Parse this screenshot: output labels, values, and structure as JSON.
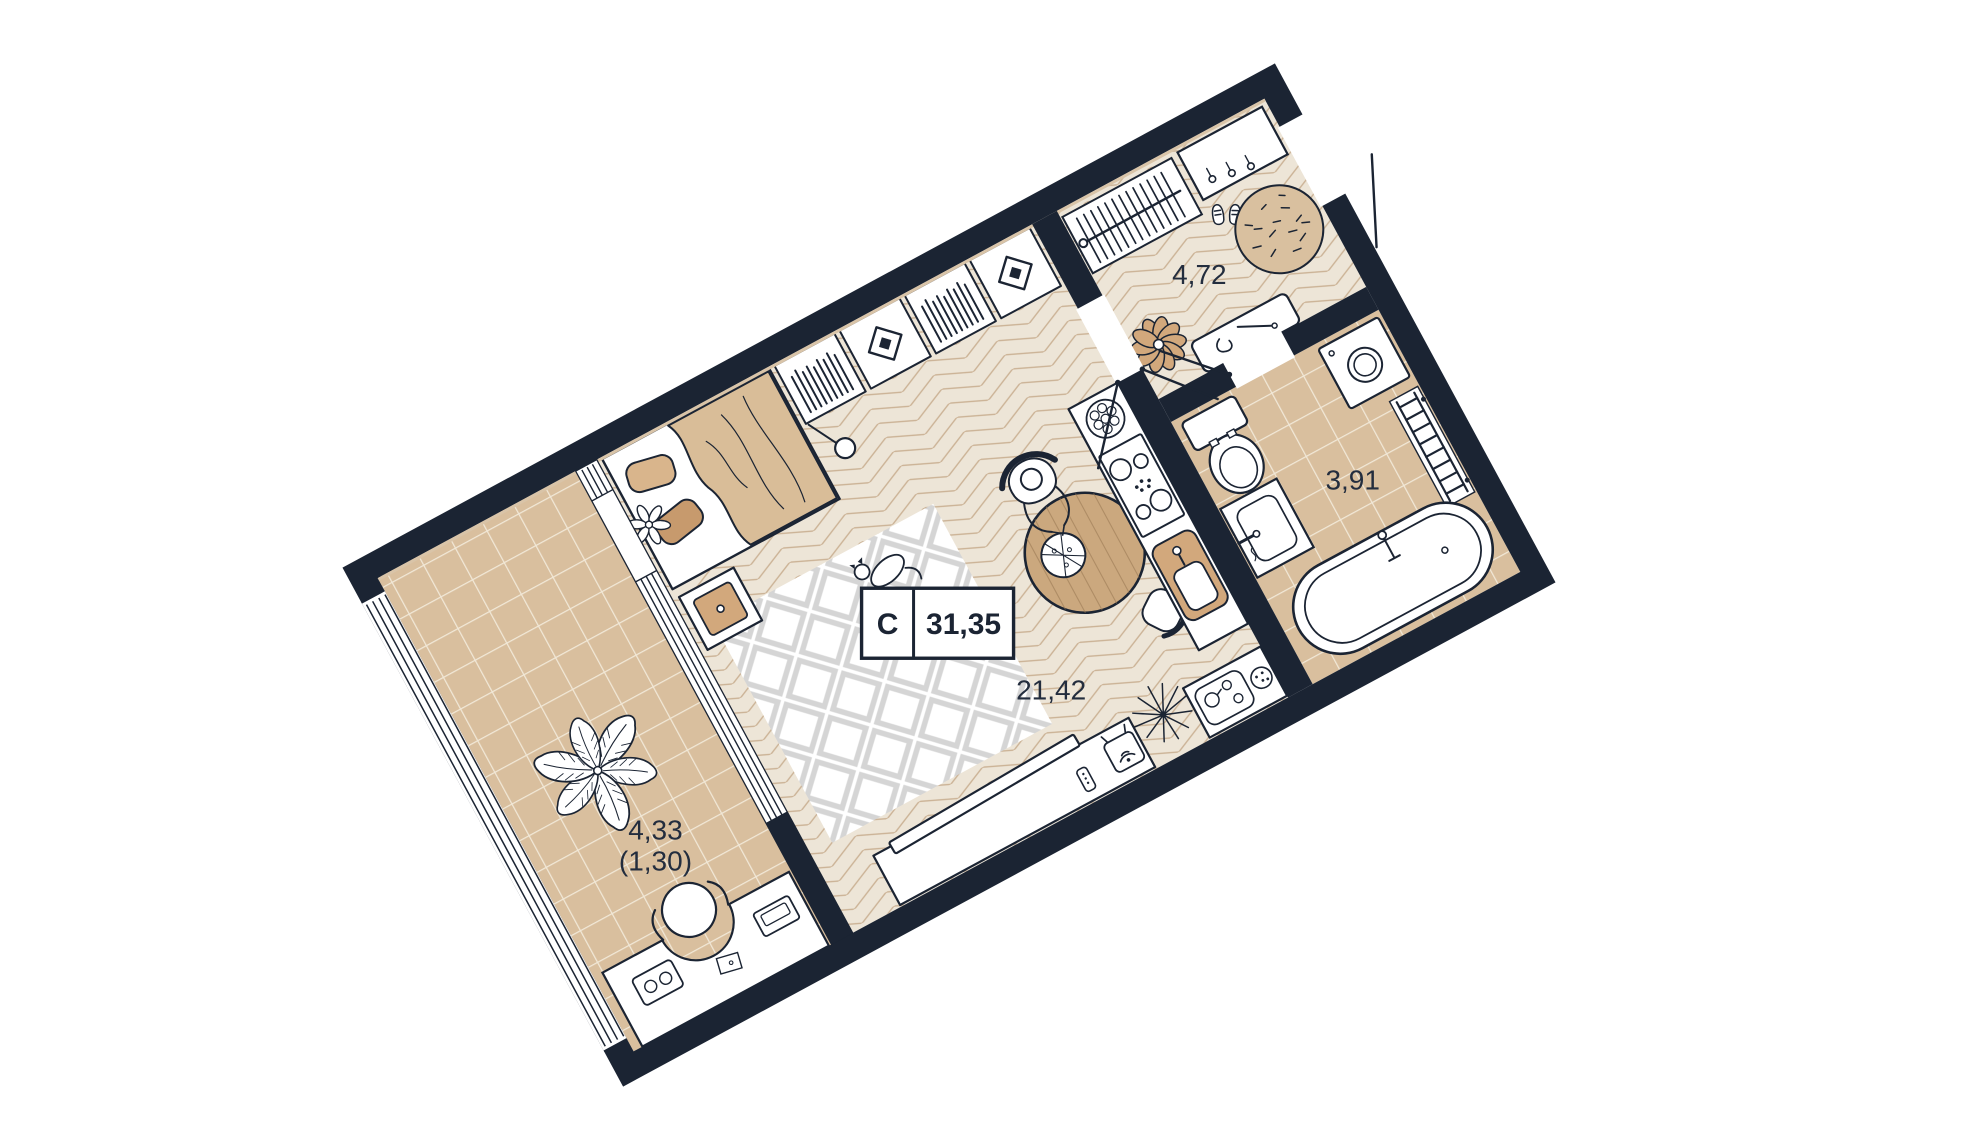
{
  "plan": {
    "type_label": "С",
    "total_area": "31,35",
    "rooms": {
      "living_kitchen": {
        "area": "21,42"
      },
      "hallway": {
        "area": "4,72"
      },
      "bathroom": {
        "area": "3,91"
      },
      "balcony": {
        "area": "4,33",
        "area_reduced": "(1,30)"
      }
    },
    "colors": {
      "walls": "#1b2433",
      "parquet_floor": "#ede5d7",
      "parquet_line": "#cbb295",
      "tile_floor": "#d9bf9e",
      "tile_grout": "#f1e8d7",
      "accent_tan": "#d2a87c",
      "accent_tan_dark": "#c2956a",
      "wood": "#cba87e",
      "rug_gray": "#d5d5d5",
      "label_text": "#232d3e"
    },
    "furniture": {
      "living_kitchen": [
        "bed",
        "pillows",
        "blanket",
        "nightstand",
        "area-rug",
        "cat",
        "floor-lamp",
        "shelf-books",
        "shelf-art",
        "tv-console",
        "tv",
        "remote",
        "wifi-router",
        "plant-starburst",
        "serving-counter",
        "tray",
        "dining-table",
        "pizza",
        "person",
        "chair",
        "kitchen-counter",
        "fruit-bowl",
        "stove",
        "kitchen-sink"
      ],
      "hallway": [
        "coat-rack",
        "console-shelf",
        "shoes",
        "round-rug",
        "pouf",
        "bench",
        "shoe-horn"
      ],
      "bathroom": [
        "washing-machine",
        "towel-rail",
        "toilet",
        "sink",
        "bathtub"
      ],
      "balcony": [
        "plant",
        "desk",
        "office-chair",
        "laptop",
        "radio",
        "notepad"
      ]
    }
  }
}
